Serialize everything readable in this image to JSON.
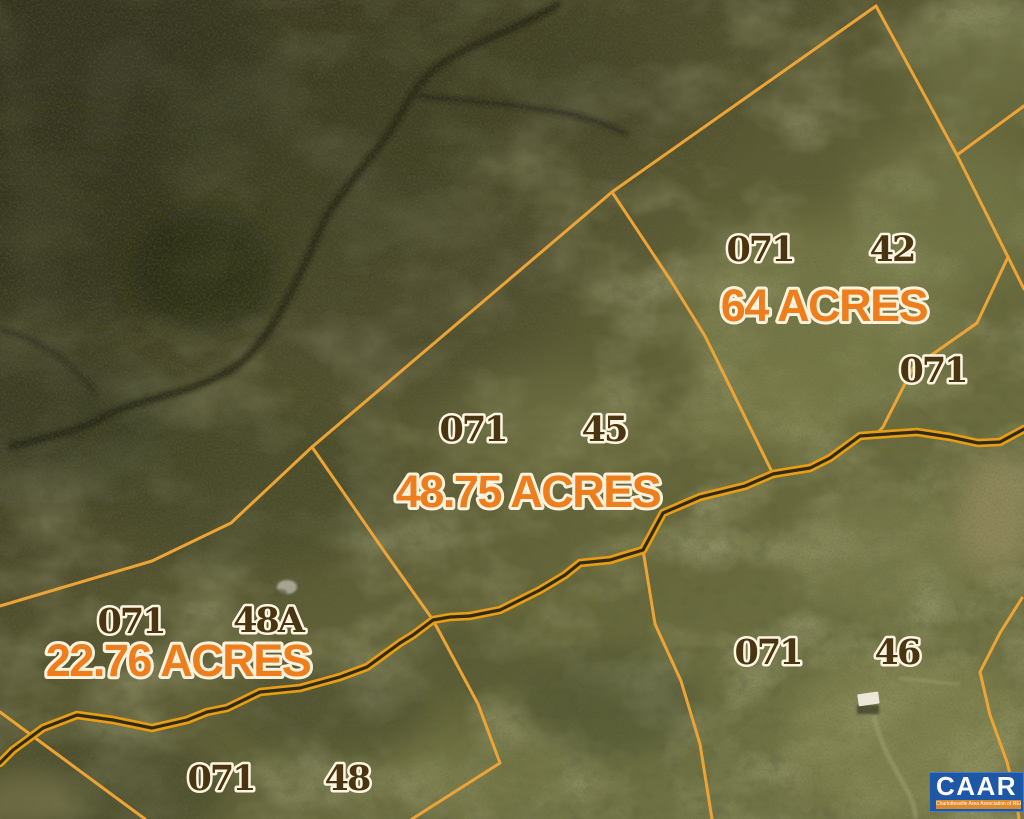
{
  "parcels": [
    {
      "tax_map": "071",
      "lot": "42",
      "acreage": "64 ACRES"
    },
    {
      "tax_map": "071",
      "lot": "45",
      "acreage": "48.75 ACRES"
    },
    {
      "tax_map": "071",
      "lot": "48A",
      "acreage": "22.76 ACRES"
    },
    {
      "tax_map": "071",
      "lot": "46"
    },
    {
      "tax_map": "071",
      "lot": "48"
    },
    {
      "tax_map": "071"
    }
  ],
  "watermark": {
    "logo_text": "CAAR",
    "tagline": "Charlottesville Area Association of REALTORS®"
  },
  "colors": {
    "parcel_boundary": "#ECA436",
    "road_casing": "#E89D13",
    "acreage_text": "#ED7D1D",
    "parcel_id_text": "#4A3512",
    "label_outline": "#FFF6E2",
    "logo_blue": "#1F57A7",
    "logo_strip_orange": "#DC8A2C"
  }
}
